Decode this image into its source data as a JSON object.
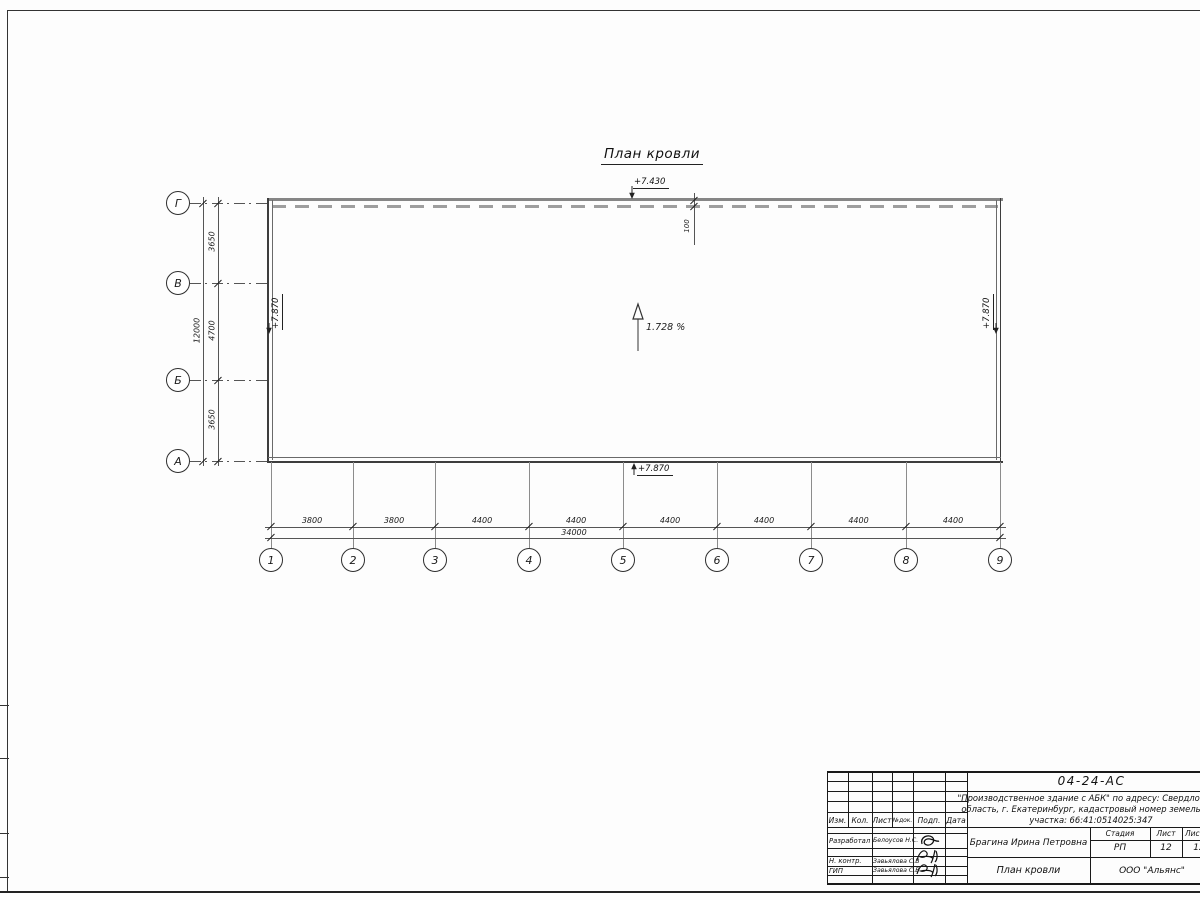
{
  "sheet": {
    "drawing_title": "План кровли",
    "slope_label": "1.728 %",
    "elevation_top": "+7.430",
    "elevation_left": "+7.870",
    "elevation_right": "+7.870",
    "elevation_bottom": "+7.870",
    "parapet_offset": "100",
    "axes_horizontal": [
      "1",
      "2",
      "3",
      "4",
      "5",
      "6",
      "7",
      "8",
      "9"
    ],
    "axes_vertical": [
      "Г",
      "В",
      "Б",
      "А"
    ],
    "dims_bottom": [
      "3800",
      "3800",
      "4400",
      "4400",
      "4400",
      "4400",
      "4400",
      "4400"
    ],
    "dim_bottom_total": "34000",
    "dims_left": [
      "3650",
      "4700",
      "3650"
    ],
    "dim_left_total": "12000"
  },
  "title_block": {
    "doc_number": "04-24-АС",
    "project_line1": "\"Производственное здание с АБК\" по адресу: Свердловская",
    "project_line2": "область, г. Екатеринбург, кадастровый номер земельного",
    "project_line3": "участка: 66:41:0514025:347",
    "header_cols": [
      "Изм.",
      "Кол.",
      "Лист",
      "№док.",
      "Подп.",
      "Дата"
    ],
    "rows": [
      {
        "role": "Разработал",
        "name": "Белоусов Н.С."
      },
      {
        "role": "Н. контр.",
        "name": "Завьялова С.В"
      },
      {
        "role": "ГИП",
        "name": "Завьялова С.В"
      }
    ],
    "author": "Брагина Ирина Петровна",
    "stage_label": "Стадия",
    "sheet_label": "Лист",
    "sheets_label": "Листов",
    "stage_value": "РП",
    "sheet_value": "12",
    "sheets_value": "12",
    "sheet_title": "План кровли",
    "company": "ООО \"Альянс\""
  }
}
